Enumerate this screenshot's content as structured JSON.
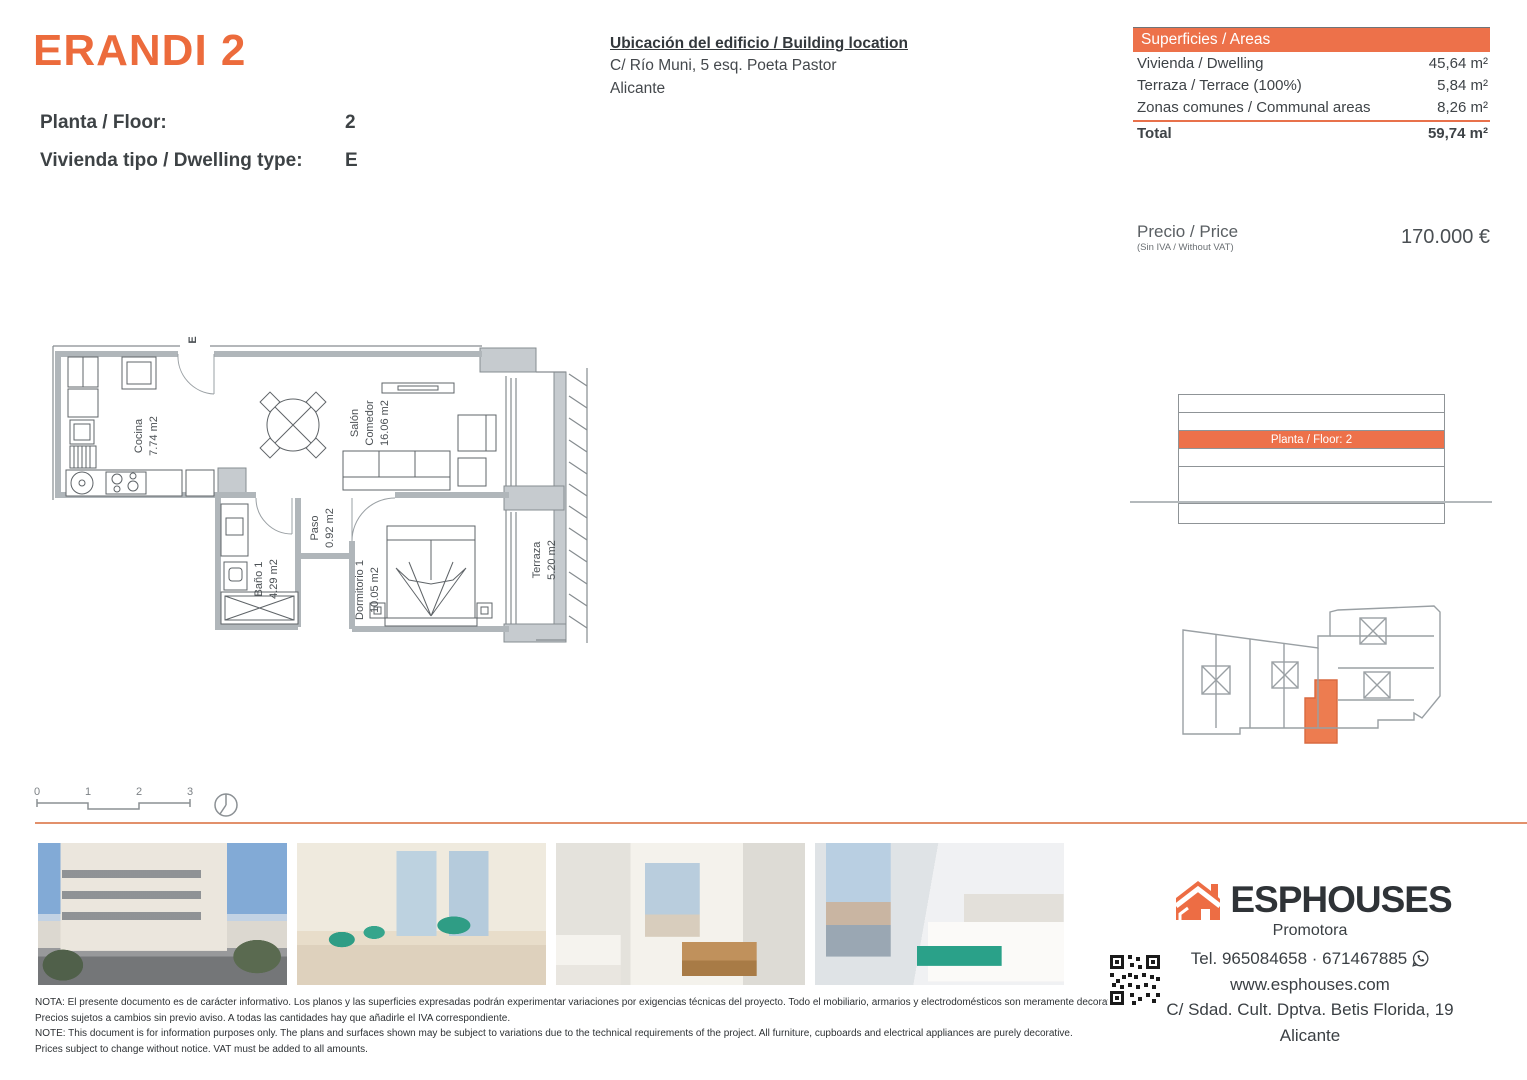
{
  "header": {
    "title": "ERANDI 2",
    "floor_label": "Planta / Floor:",
    "floor_value": "2",
    "type_label": "Vivienda tipo / Dwelling type:",
    "type_value": "E"
  },
  "location": {
    "heading": "Ubicación del edificio / Building location",
    "line1": "C/ Río Muni, 5 esq. Poeta Pastor",
    "line2": "Alicante"
  },
  "areas": {
    "heading": "Superficies / Areas",
    "rows": [
      {
        "label": "Vivienda / Dwelling",
        "value": "45,64 m²"
      },
      {
        "label": "Terraza / Terrace (100%)",
        "value": "5,84 m²"
      },
      {
        "label": "Zonas comunes / Communal areas",
        "value": "8,26 m²"
      }
    ],
    "total_label": "Total",
    "total_value": "59,74 m²"
  },
  "price": {
    "label": "Precio / Price",
    "sublabel": "(Sin IVA / Without VAT)",
    "value": "170.000 €"
  },
  "floorplan": {
    "entry_label": "E",
    "rooms": {
      "cocina": {
        "name": "Cocina",
        "area": "7.74 m2"
      },
      "salon": {
        "name": "Salón",
        "name2": "Comedor",
        "area": "16.06 m2"
      },
      "paso": {
        "name": "Paso",
        "area": "0.92 m2"
      },
      "bano": {
        "name": "Baño 1",
        "area": "4.29 m2"
      },
      "dormitorio": {
        "name": "Dormitorio 1",
        "area": "10.05 m2"
      },
      "terraza": {
        "name": "Terraza",
        "area": "5.20 m2"
      }
    },
    "scalebar": {
      "t0": "0",
      "t1": "1",
      "t2": "2",
      "t3": "3"
    }
  },
  "section_diagram": {
    "highlight_label": "Planta / Floor: 2"
  },
  "footer": {
    "notes": [
      "NOTA: El presente documento es de carácter informativo. Los planos y las superficies expresadas podrán experimentar variaciones por exigencias técnicas del proyecto. Todo el mobiliario, armarios y electrodomésticos son meramente decorativos.",
      "Precios sujetos a cambios sin previo aviso. A todas las cantidades hay que añadirle el IVA correspondiente.",
      "NOTE: This document is for information purposes only. The plans and surfaces shown may be subject to variations due to the technical requirements of the project. All furniture, cupboards and electrical appliances are purely decorative.",
      "Prices subject to change without notice. VAT must be added to all amounts."
    ],
    "brand": {
      "name": "ESPHOUSES",
      "tagline": "Promotora"
    },
    "contact": {
      "phone": "Tel. 965084658 · 671467885",
      "web": "www.esphouses.com",
      "address": "C/ Sdad. Cult. Dptva. Betis Florida, 19",
      "city": "Alicante"
    }
  },
  "colors": {
    "accent": "#EC6B3C",
    "accent_bar": "#ED714A",
    "separator": "#E2906B"
  }
}
